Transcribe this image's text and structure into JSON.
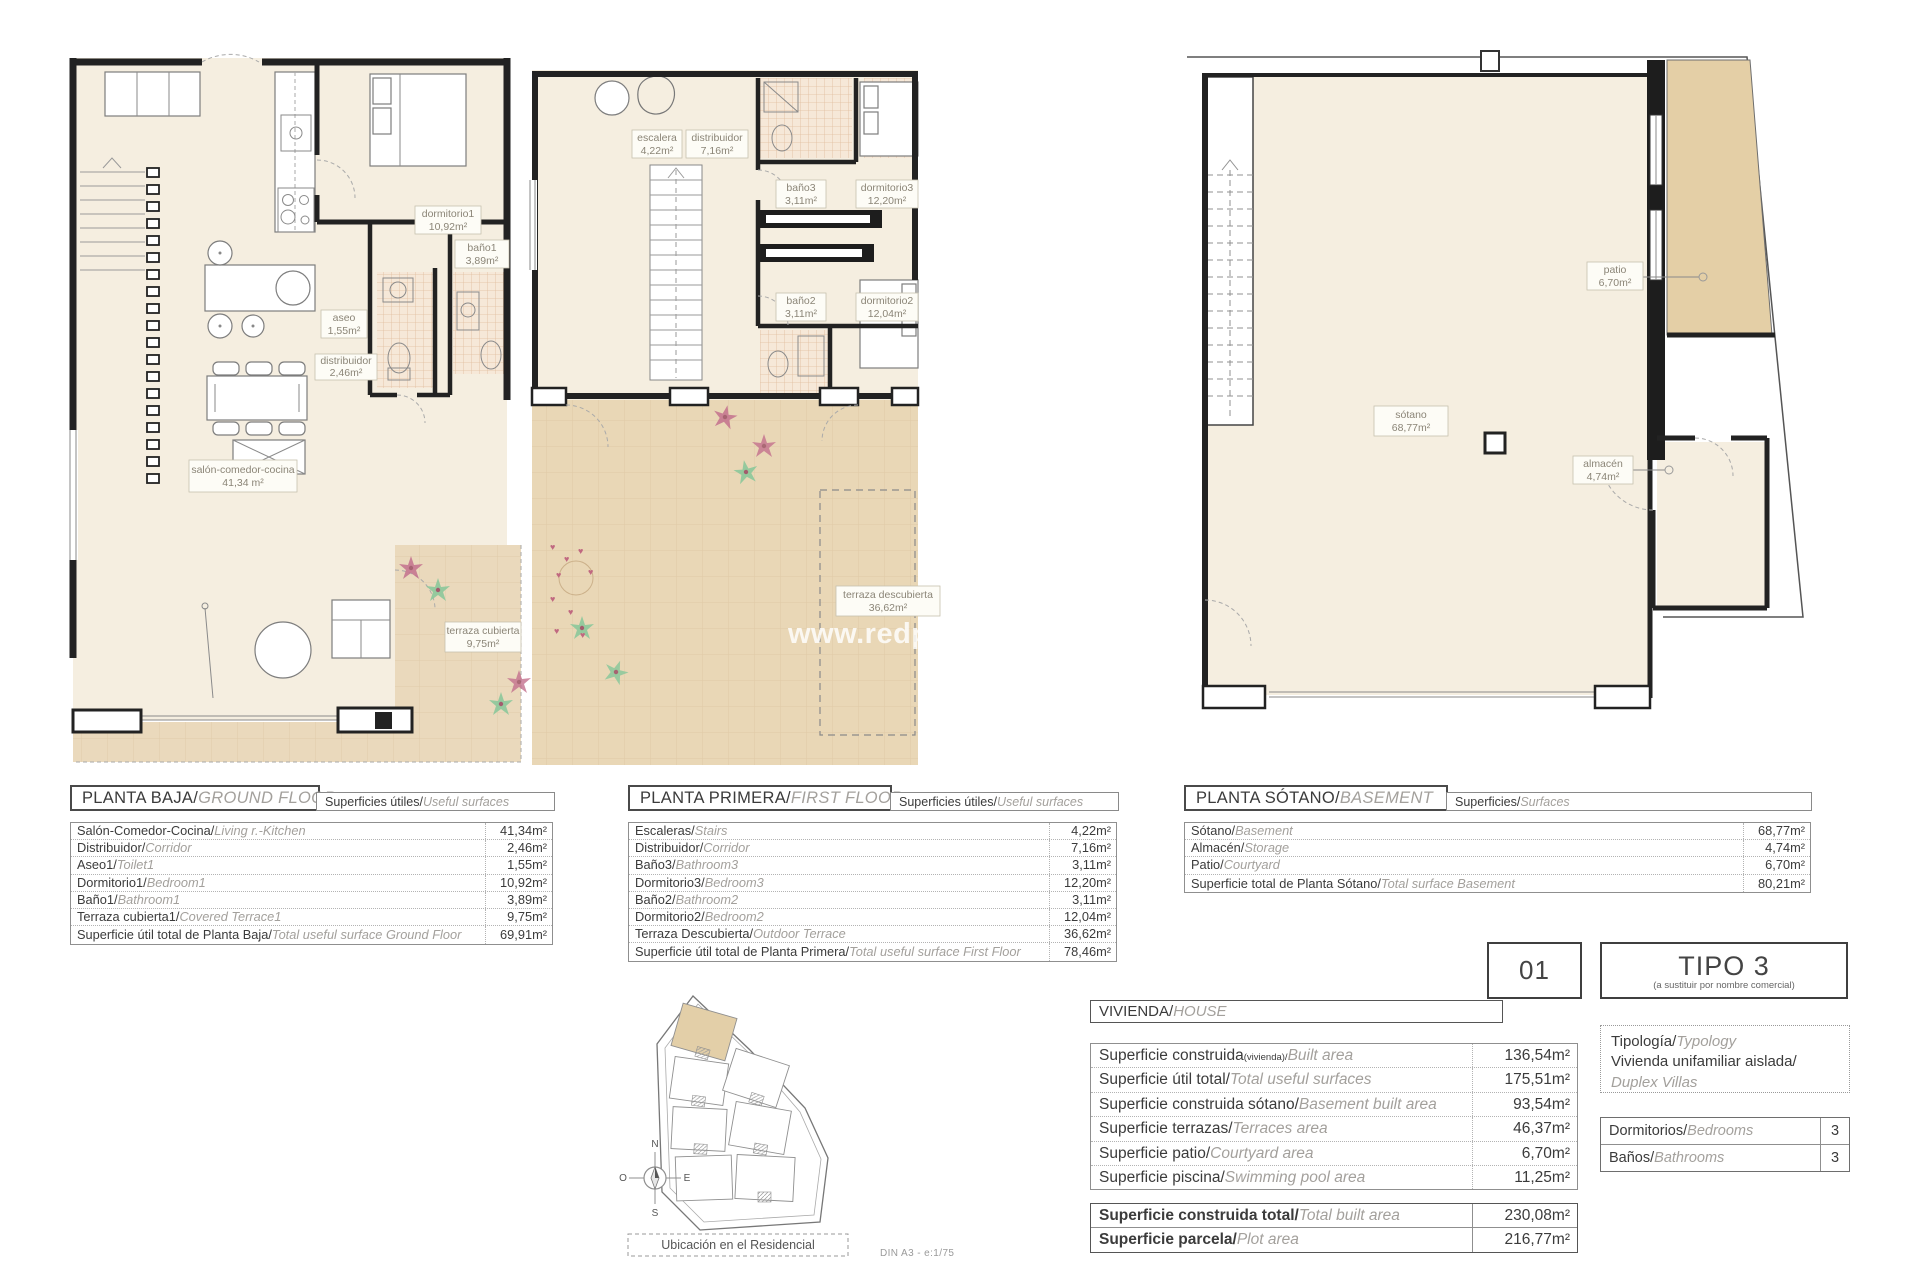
{
  "watermark": "www.redpalmestate.com",
  "footer": "DIN A3 - e:1/75",
  "colors": {
    "floor": "#f5eee0",
    "terrace": "#e9d7b6",
    "patio": "#e4cfa6",
    "wall": "#222222",
    "accent_pink": "#c4718e",
    "accent_green": "#8cc89b"
  },
  "ground": {
    "title_es": "PLANTA BAJA/",
    "title_en": "GROUND FLOOR",
    "sub_es": "Superficies útiles/",
    "sub_en": "Useful surfaces",
    "rooms": {
      "dormitorio1": {
        "label": "dormitorio1",
        "area": "10,92m²"
      },
      "bano1": {
        "label": "baño1",
        "area": "3,89m²"
      },
      "aseo": {
        "label": "aseo",
        "area": "1,55m²"
      },
      "distribuidor": {
        "label": "distribuidor",
        "area": "2,46m²"
      },
      "salon": {
        "label": "salón-comedor-cocina",
        "area": "41,34 m²"
      },
      "terraza": {
        "label": "terraza cubierta",
        "area": "9,75m²"
      }
    },
    "rows": [
      {
        "es": "Salón-Comedor-Cocina/",
        "en": "Living r.-Kitchen",
        "v": "41,34m²"
      },
      {
        "es": "Distribuidor/",
        "en": "Corridor",
        "v": "2,46m²"
      },
      {
        "es": "Aseo1/",
        "en": "Toilet1",
        "v": "1,55m²"
      },
      {
        "es": "Dormitorio1/",
        "en": "Bedroom1",
        "v": "10,92m²"
      },
      {
        "es": "Baño1/",
        "en": "Bathroom1",
        "v": "3,89m²"
      },
      {
        "es": "Terraza cubierta1/",
        "en": "Covered Terrace1",
        "v": "9,75m²"
      }
    ],
    "total": {
      "es": "Superficie útil total de Planta Baja/",
      "en": "Total useful surface Ground Floor",
      "v": "69,91m²"
    }
  },
  "first": {
    "title_es": "PLANTA PRIMERA/",
    "title_en": "FIRST FLOOR",
    "sub_es": "Superficies útiles/",
    "sub_en": "Useful surfaces",
    "rooms": {
      "escalera": {
        "label": "escalera",
        "area": "4,22m²"
      },
      "distribuidor": {
        "label": "distribuidor",
        "area": "7,16m²"
      },
      "bano3": {
        "label": "baño3",
        "area": "3,11m²"
      },
      "dormitorio3": {
        "label": "dormitorio3",
        "area": "12,20m²"
      },
      "bano2": {
        "label": "baño2",
        "area": "3,11m²"
      },
      "dormitorio2": {
        "label": "dormitorio2",
        "area": "12,04m²"
      },
      "terraza": {
        "label": "terraza descubierta",
        "area": "36,62m²"
      }
    },
    "rows": [
      {
        "es": "Escaleras/",
        "en": "Stairs",
        "v": "4,22m²"
      },
      {
        "es": "Distribuidor/",
        "en": "Corridor",
        "v": "7,16m²"
      },
      {
        "es": "Baño3/",
        "en": "Bathroom3",
        "v": "3,11m²"
      },
      {
        "es": "Dormitorio3/",
        "en": "Bedroom3",
        "v": "12,20m²"
      },
      {
        "es": "Baño2/",
        "en": "Bathroom2",
        "v": "3,11m²"
      },
      {
        "es": "Dormitorio2/",
        "en": "Bedroom2",
        "v": "12,04m²"
      },
      {
        "es": "Terraza Descubierta/",
        "en": "Outdoor Terrace",
        "v": "36,62m²"
      }
    ],
    "total": {
      "es": "Superficie útil total de Planta Primera/",
      "en": "Total useful surface First Floor",
      "v": "78,46m²"
    }
  },
  "basement": {
    "title_es": "PLANTA SÓTANO/",
    "title_en": "BASEMENT",
    "sub_es": "Superficies/",
    "sub_en": "Surfaces",
    "rooms": {
      "sotano": {
        "label": "sótano",
        "area": "68,77m²"
      },
      "patio": {
        "label": "patio",
        "area": "6,70m²"
      },
      "almacen": {
        "label": "almacén",
        "area": "4,74m²"
      }
    },
    "rows": [
      {
        "es": "Sótano/",
        "en": "Basement",
        "v": "68,77m²"
      },
      {
        "es": "Almacén/",
        "en": "Storage",
        "v": "4,74m²"
      },
      {
        "es": "Patio/",
        "en": "Courtyard",
        "v": "6,70m²"
      }
    ],
    "total": {
      "es": "Superficie total de Planta Sótano/",
      "en": "Total surface Basement",
      "v": "80,21m²"
    }
  },
  "house": {
    "title_es": "VIVIENDA/",
    "title_en": "HOUSE",
    "rows": [
      {
        "es": "Superficie construida",
        "sub": "(vivienda)/",
        "en": "Built area",
        "v": "136,54m²"
      },
      {
        "es": "Superficie útil total/",
        "en": "Total useful surfaces",
        "v": "175,51m²"
      },
      {
        "es": "Superficie construida sótano/",
        "en": "Basement built area",
        "v": "93,54m²"
      },
      {
        "es": "Superficie terrazas/",
        "en": "Terraces area",
        "v": "46,37m²"
      },
      {
        "es": "Superficie patio/",
        "en": "Courtyard area",
        "v": "6,70m²"
      },
      {
        "es": "Superficie piscina/",
        "en": "Swimming pool area",
        "v": "11,25m²"
      }
    ],
    "totals": [
      {
        "es": "Superficie construida total/",
        "en": "Total built area",
        "v": "230,08m²"
      },
      {
        "es": "Superficie parcela/",
        "en": "Plot area",
        "v": "216,77m²"
      }
    ]
  },
  "panel": {
    "unit": "01",
    "type": "TIPO 3",
    "type_note": "(a sustituir por nombre comercial)",
    "typology_es": "Tipología/",
    "typology_en": "Typology",
    "typology_line2": "Vivienda unifamiliar aislada/",
    "typology_line3": "Duplex Villas",
    "counts": [
      {
        "es": "Dormitorios/",
        "en": "Bedrooms",
        "v": "3"
      },
      {
        "es": "Baños/",
        "en": "Bathrooms",
        "v": "3"
      }
    ]
  },
  "site": {
    "caption": "Ubicación en el Residencial",
    "compass": {
      "n": "N",
      "s": "S",
      "e": "E",
      "o": "O"
    }
  }
}
